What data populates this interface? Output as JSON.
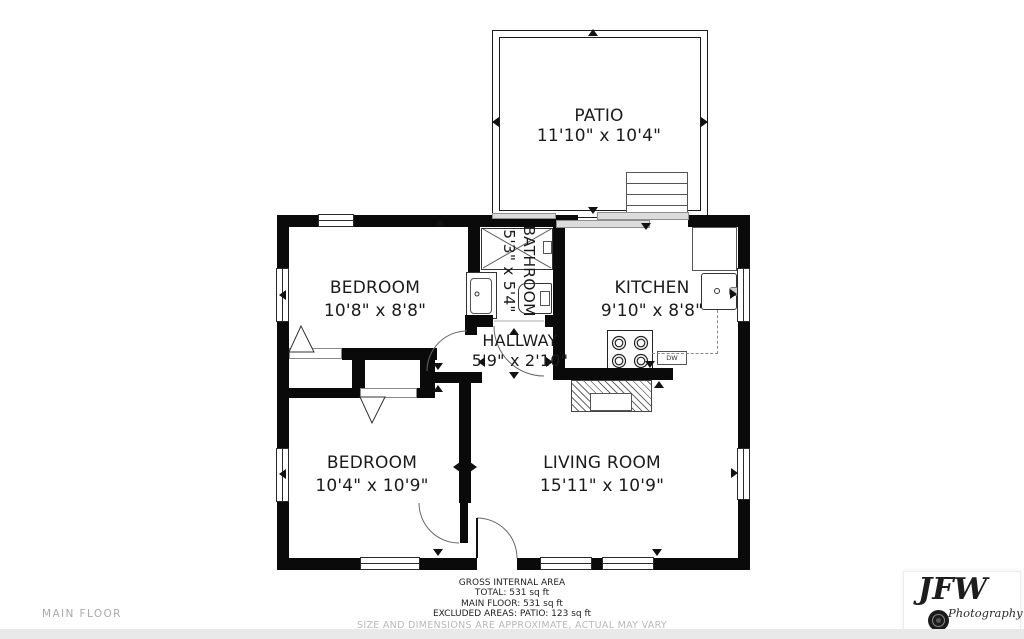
{
  "rooms": {
    "patio": {
      "name": "PATIO",
      "dims": "11'10\" x 10'4\""
    },
    "bedroom1": {
      "name": "BEDROOM",
      "dims": "10'8\" x 8'8\""
    },
    "bathroom": {
      "name": "BATHROOM",
      "dims": "5'3\" x 5'4\""
    },
    "kitchen": {
      "name": "KITCHEN",
      "dims": "9'10\" x 8'8\""
    },
    "hallway": {
      "name": "HALLWAY",
      "dims": "5'9\" x 2'10\""
    },
    "bedroom2": {
      "name": "BEDROOM",
      "dims": "10'4\" x 10'9\""
    },
    "living": {
      "name": "LIVING ROOM",
      "dims": "15'11\" x 10'9\""
    }
  },
  "kitchen_labels": {
    "dishwasher": "DW"
  },
  "footer": {
    "heading": "GROSS INTERNAL AREA",
    "total": "TOTAL: 531 sq ft",
    "main_floor": "MAIN FLOOR: 531 sq ft",
    "excluded": "EXCLUDED AREAS: PATIO: 123 sq ft",
    "disclaimer": "SIZE AND DIMENSIONS ARE APPROXIMATE, ACTUAL MAY VARY"
  },
  "floor_label": "MAIN FLOOR",
  "logo": {
    "initials": "JFW",
    "subtitle": "Photography"
  },
  "colors": {
    "wall": "#0a0a0a",
    "line": "#555555",
    "slider": "#dcdcdc",
    "muted_text": "#b8b8b8",
    "strip": "#e9e9e9"
  }
}
